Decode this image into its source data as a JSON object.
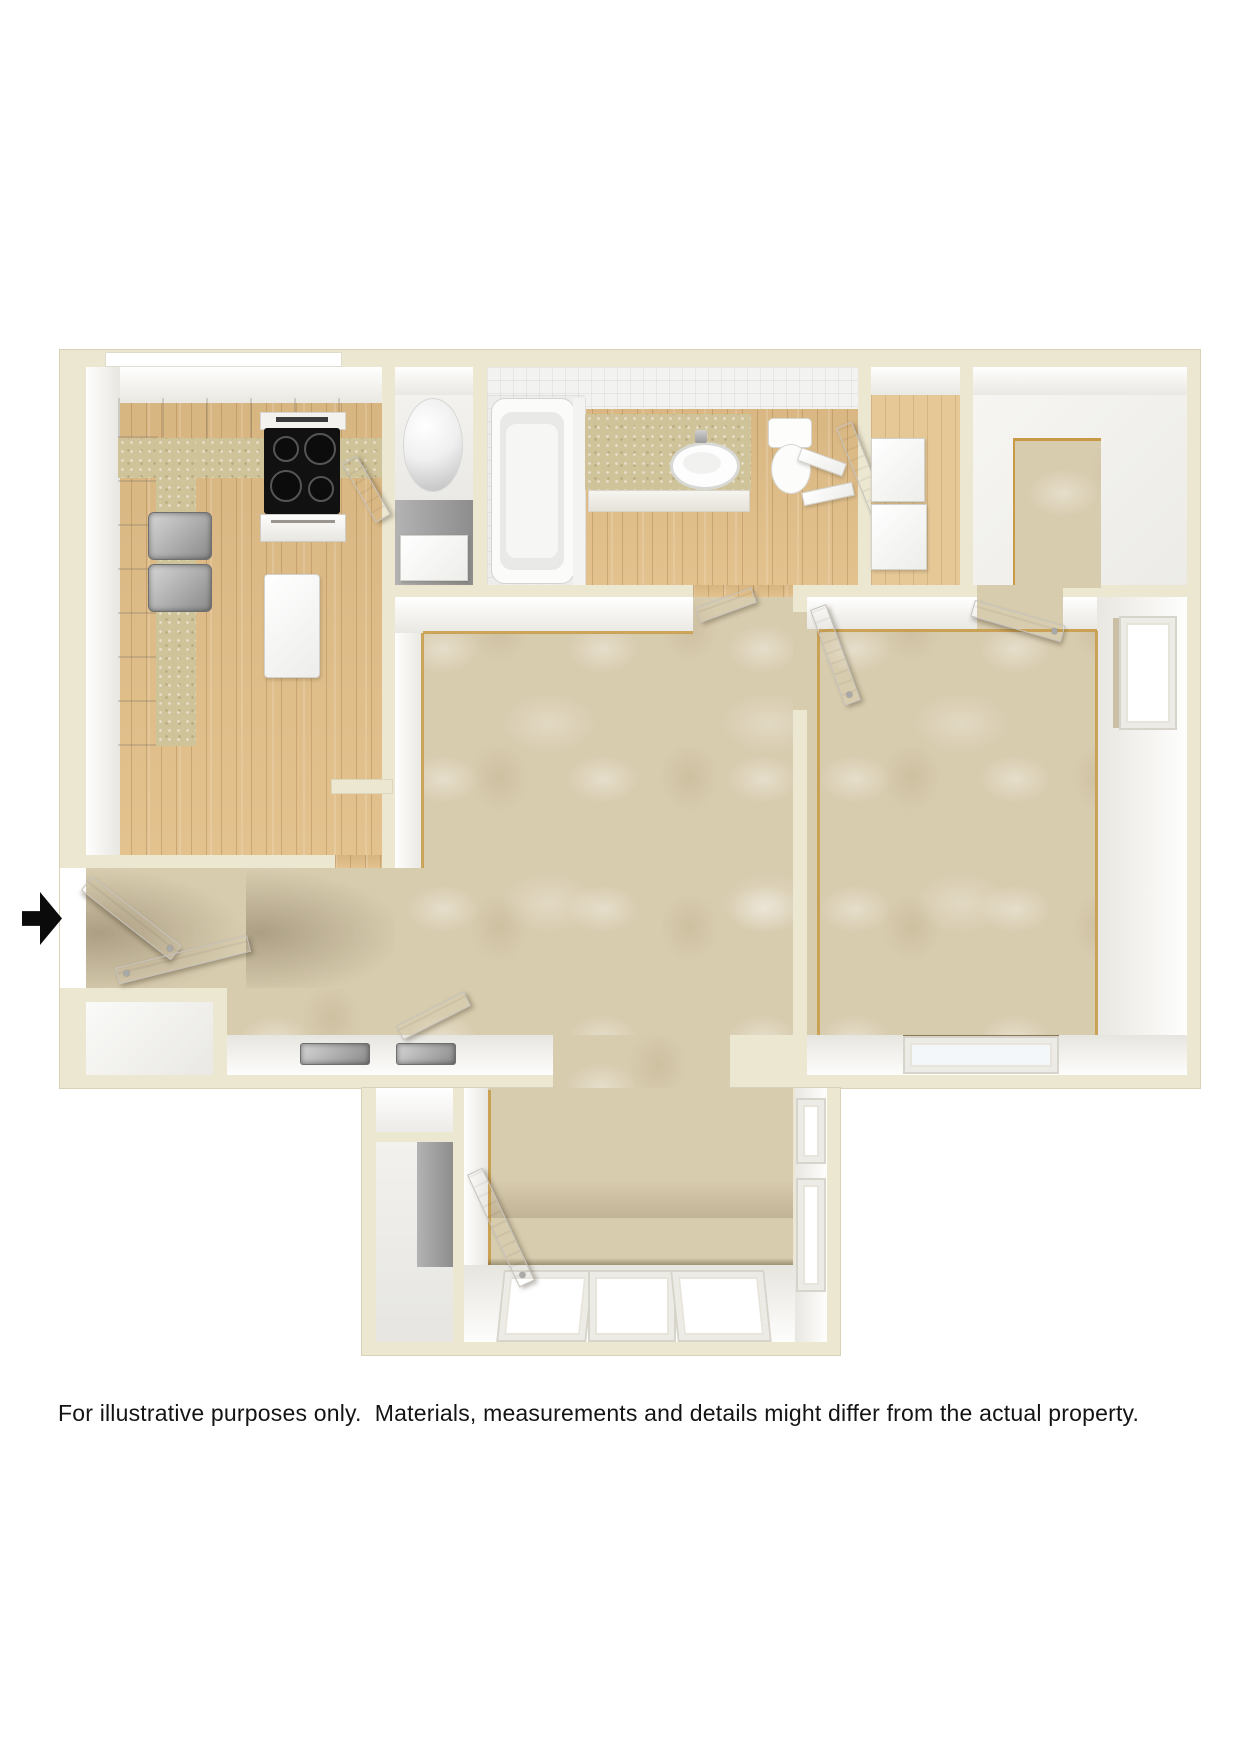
{
  "disclaimer": "For illustrative purposes only.  Materials, measurements and details might differ from the actual property.",
  "colors": {
    "background": "#ffffff",
    "wall": "#ece7d1",
    "wall_outline": "#d8d2b8",
    "wall_face": "#f5f4f0",
    "carpet": "#d8ccaf",
    "wood": "#dfbd89",
    "counter": "#cfc39a",
    "tack_strip": "#c89a45",
    "appliance_black": "#111111",
    "stainless": "#a8a8a8",
    "fixture_white": "#fdfdfd",
    "closet_gray": "#9b9b9b"
  },
  "floorplan": {
    "entry_marker": "black-arrow-pointing-right",
    "rooms": [
      {
        "name": "kitchen",
        "floor": "wood",
        "fixtures": [
          "l-shaped-cabinets",
          "countertop",
          "range-with-oven",
          "double-sink",
          "island"
        ]
      },
      {
        "name": "utility-closet",
        "floor": "vinyl",
        "fixtures": [
          "water-heater"
        ]
      },
      {
        "name": "bathroom",
        "floor": "wood",
        "fixtures": [
          "bathtub",
          "vanity-counter",
          "oval-sink",
          "toilet",
          "linen-shelves"
        ]
      },
      {
        "name": "hall-closet",
        "floor": "wood",
        "fixtures": [
          "stacked-shelf-boxes"
        ]
      },
      {
        "name": "bedroom-closet-room",
        "floor": "carpet-and-bare"
      },
      {
        "name": "living-room",
        "floor": "carpet"
      },
      {
        "name": "entry",
        "floor": "carpet",
        "fixtures": [
          "entry-door",
          "coat-closet",
          "wall-vents"
        ]
      },
      {
        "name": "bedroom-1",
        "floor": "carpet",
        "fixtures": [
          "side-window",
          "bottom-window",
          "closet-door",
          "entry-door"
        ]
      },
      {
        "name": "bedroom-2",
        "floor": "carpet",
        "fixtures": [
          "three-bottom-windows",
          "two-side-windows",
          "two-closets",
          "entry-door"
        ]
      }
    ]
  }
}
